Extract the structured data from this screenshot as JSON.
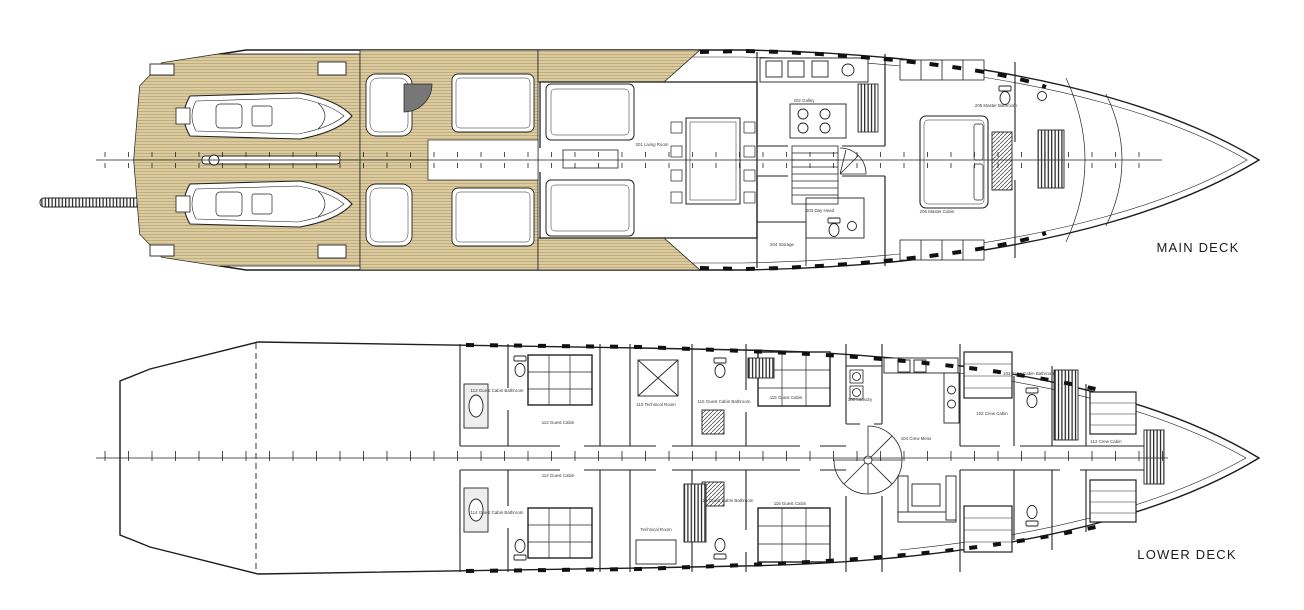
{
  "drawing": {
    "type": "yacht-general-arrangement",
    "background": "#ffffff",
    "line_color": "#222222",
    "teak_color": "#dccb9f",
    "teak_stripe_color": "#b5a173"
  },
  "main_deck": {
    "label": "MAIN DECK",
    "rooms": {
      "living_room": "201 Living Room",
      "galley": "202 Galley",
      "day_head": "203 Day Head",
      "storage": "204 Storage",
      "master_bathroom": "205 Master Bathroom",
      "master_cabin": "206 Master Cabin"
    }
  },
  "lower_deck": {
    "label": "LOWER DECK",
    "rooms": {
      "crew_cabin_fwd": "102 Crew Cabin",
      "crew_bathroom": "103 Crew Cabin Bathroom",
      "crew_mess": "104 Crew Mess",
      "laundry": "108 Laundry",
      "technical_room": "110 Technical Room",
      "crew_cabin_bow": "112 Crew Cabin",
      "guest_cabin_1": "113 Guest Cabin",
      "guest_cabin_1_bathroom": "113 Guest Cabin Bathroom",
      "guest_cabin_2": "114 Guest Cabin",
      "guest_cabin_2_bathroom": "114 Guest Cabin Bathroom",
      "guest_cabin_3": "115 Guest Cabin",
      "guest_cabin_3_bathroom": "115 Guest Cabin Bathroom",
      "guest_cabin_4": "116 Guest Cabin",
      "guest_cabin_4_bathroom": "116 Guest Cabin Bathroom",
      "technical_room_aft": "Technical Room"
    }
  }
}
